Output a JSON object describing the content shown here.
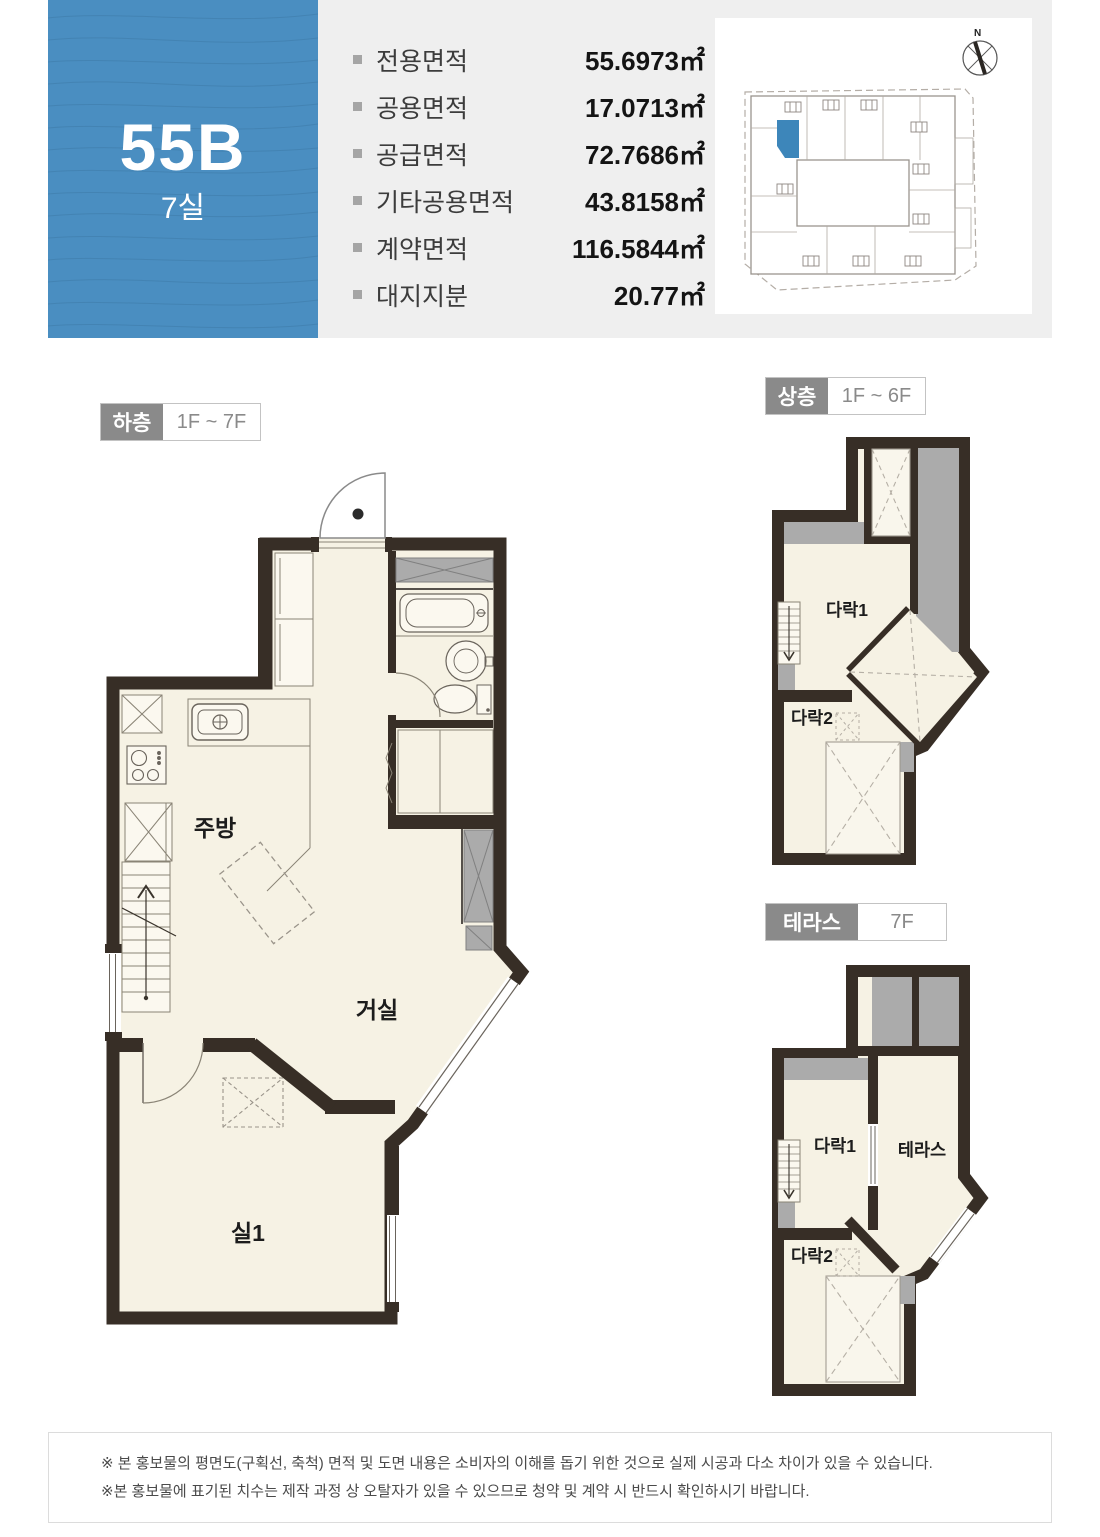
{
  "unit": {
    "code": "55B",
    "rooms": "7실"
  },
  "specs": {
    "items": [
      {
        "label": "전용면적",
        "value": "55.6973㎡"
      },
      {
        "label": "공용면적",
        "value": "17.0713㎡"
      },
      {
        "label": "공급면적",
        "value": "72.7686㎡"
      },
      {
        "label": "기타공용면적",
        "value": "43.8158㎡"
      },
      {
        "label": "계약면적",
        "value": "116.5844㎡"
      },
      {
        "label": "대지지분",
        "value": "20.77㎡"
      }
    ]
  },
  "site_plan": {
    "north_label": "N"
  },
  "plans": {
    "lower": {
      "tag": "하층",
      "range": "1F ~ 7F",
      "rooms": {
        "kitchen": "주방",
        "living": "거실",
        "room1": "실1"
      }
    },
    "upper": {
      "tag": "상층",
      "range": "1F ~ 6F",
      "rooms": {
        "attic1": "다락1",
        "attic2": "다락2"
      }
    },
    "terrace": {
      "tag": "테라스",
      "range": "7F",
      "rooms": {
        "attic1": "다락1",
        "attic2": "다락2",
        "terrace": "테라스"
      }
    }
  },
  "footer": {
    "lines": [
      "※ 본 홍보물의 평면도(구획선, 축척) 면적 및 도면 내용은 소비자의 이해를 돕기 위한 것으로 실제 시공과 다소 차이가 있을 수 있습니다.",
      "※본 홍보물에 표기된 치수는 제작 과정 상 오탈자가 있을 수 있으므로 청약 및 계약 시 반드시 확인하시기 바랍니다."
    ]
  },
  "colors": {
    "accent_blue": "#4a8ec1",
    "highlight_unit_blue": "#3d86ba",
    "wall_dark": "#372e26",
    "floor_cream": "#f6f2e4",
    "shaft_gray": "#ababab",
    "header_band_gray": "#efefef",
    "tag_gray": "#8a8a8a"
  }
}
